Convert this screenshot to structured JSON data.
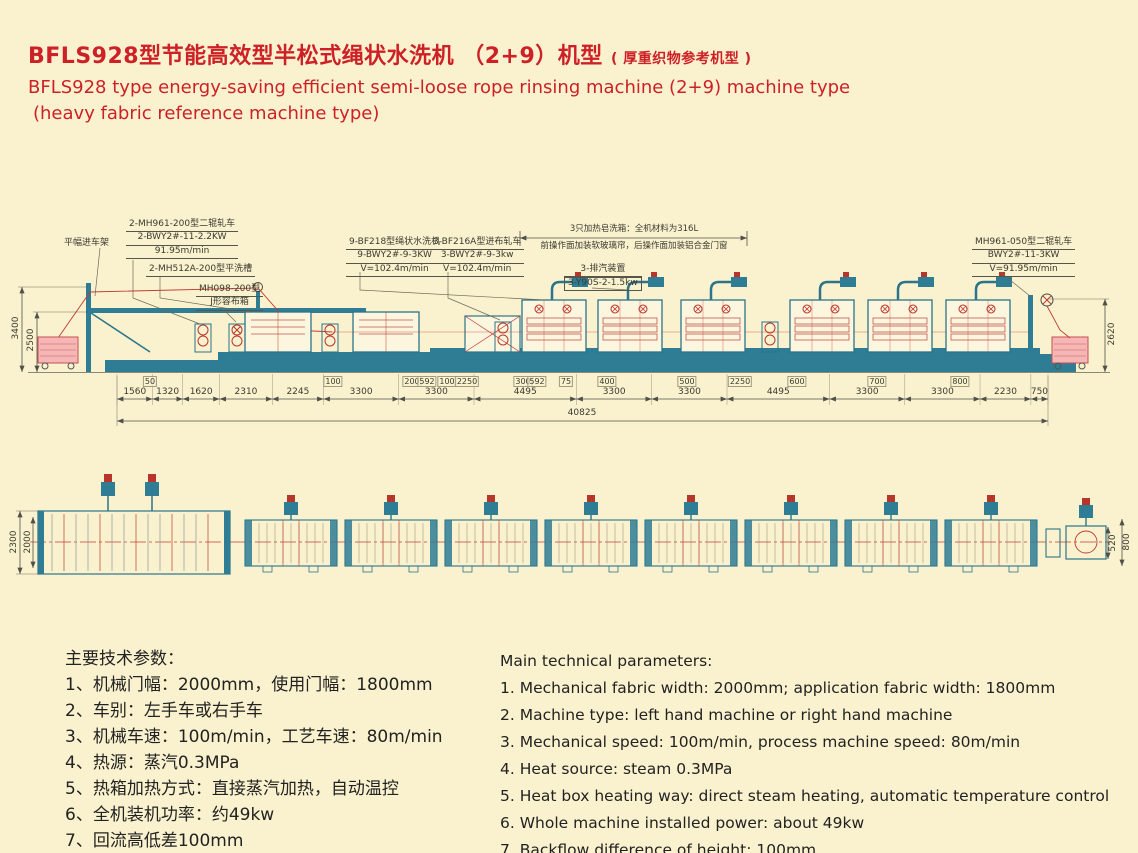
{
  "title": {
    "zh_main": "BFLS928型节能高效型半松式绳状水洗机 （2+9）机型",
    "zh_note": "( 厚重织物参考机型 )",
    "en_line1": "BFLS928 type energy-saving efficient semi-loose rope rinsing machine (2+9) machine type",
    "en_line2": "(heavy fabric reference machine type)"
  },
  "colors": {
    "background": "#FAF2CE",
    "title_red": "#CD2027",
    "machine_teal": "#2E7D95",
    "machine_outline": "#2B7489",
    "detail_red": "#B8352C",
    "dim_text": "#3A3A30"
  },
  "elevation": {
    "callouts": {
      "entry_frame": "平幅进车架",
      "mangle_left": [
        "2-MH961-200型二辊轧车",
        "2-BWY2#-11-2.2KW",
        "91.95m/min"
      ],
      "flat_washer": "2-MH512A-200型平洗槽",
      "j_box": [
        "MH098-200型",
        "J形容布箱"
      ],
      "rope_washer": [
        "9-BF218型绳状水洗机",
        "9-BWY2#-9-3KW",
        "V=102.4m/min"
      ],
      "feed_mangle": [
        "3-BF216A型进布轧车",
        "3-BWY2#-9-3kw",
        "V=102.4m/min"
      ],
      "soap_note1": "3只加热皂洗箱：全机材料为316L",
      "soap_note2": "前操作面加装软玻璃帘，后操作面加装铝合金门窗",
      "exhaust": [
        "3-排汽装置",
        "3-Y90S-2-1.5kw"
      ],
      "mangle_right": [
        "MH961-050型二辊轧车",
        "BWY2#-11-3KW",
        "V=91.95m/min"
      ]
    },
    "chain_mm": [
      1560,
      1320,
      1620,
      2310,
      2245,
      3300,
      3300,
      4495,
      3300,
      3300,
      4495,
      3300,
      3300,
      2230,
      750
    ],
    "total_label": "40825",
    "upper_dims": [
      "50",
      "100",
      "200",
      "592",
      "100",
      "2250",
      "300",
      "592",
      "75",
      "400",
      "500",
      "2250",
      "600",
      "700",
      "800"
    ],
    "v_dim_left_outer": "3400",
    "v_dim_left_inner": "2500",
    "v_dim_right": "2620"
  },
  "plan": {
    "v_dim_left_outer": "2300",
    "v_dim_left_inner": "2000",
    "v_dim_right_inner": "520",
    "v_dim_right_outer": "800"
  },
  "params_zh": {
    "heading": "主要技术参数：",
    "items": [
      "1、机械门幅：2000mm，使用门幅：1800mm",
      "2、车别：左手车或右手车",
      "3、机械车速：100m/min，工艺车速：80m/min",
      "4、热源：蒸汽0.3MPa",
      "5、热箱加热方式：直接蒸汽加热，自动温控",
      "6、全机装机功率：约49kw",
      "7、回流高低差100mm"
    ]
  },
  "params_en": {
    "heading": "Main technical parameters:",
    "items": [
      "1. Mechanical fabric width: 2000mm; application fabric width: 1800mm",
      "2. Machine type: left hand machine or right hand machine",
      "3. Mechanical speed: 100m/min, process machine speed: 80m/min",
      "4. Heat source: steam 0.3MPa",
      "5. Heat box heating way: direct steam heating, automatic temperature control",
      "6. Whole machine installed power: about 49kw",
      "7. Backflow difference of height: 100mm"
    ]
  }
}
